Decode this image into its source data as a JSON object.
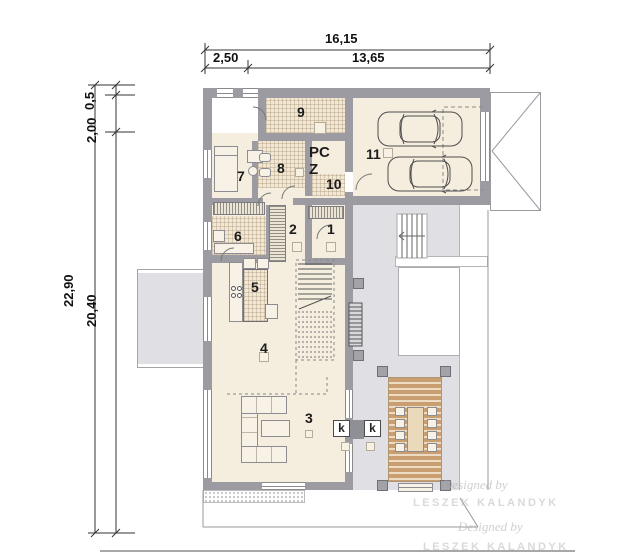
{
  "document": {
    "type": "architectural-floor-plan"
  },
  "colors": {
    "wall": "#9b9ba1",
    "floor": "#f5eedf",
    "tile_floor": "#f2e7d3",
    "terrace": "#e0e0e4",
    "deck_wood": "#c99f72",
    "outline": "#8c8c92",
    "dimension_text": "#111111"
  },
  "dimensions_top": {
    "total": "16,15",
    "segment_left": "2,50",
    "segment_right": "13,65"
  },
  "dimensions_left": {
    "overall": "22,90",
    "inner": "20,40",
    "upper": "2,00",
    "upper_small": "0,5"
  },
  "room_labels": {
    "r1": "1",
    "r2": "2",
    "r3": "3",
    "r4": "4",
    "r5": "5",
    "r6": "6",
    "r7": "7",
    "r8": "8",
    "r9": "9",
    "r10": "10",
    "r11": "11",
    "pc": "PC",
    "z": "Z"
  },
  "fireplace_labels": {
    "left": "k",
    "right": "k"
  },
  "watermark": {
    "script": "Designed by",
    "name": "LESZEK KALANDYK"
  }
}
